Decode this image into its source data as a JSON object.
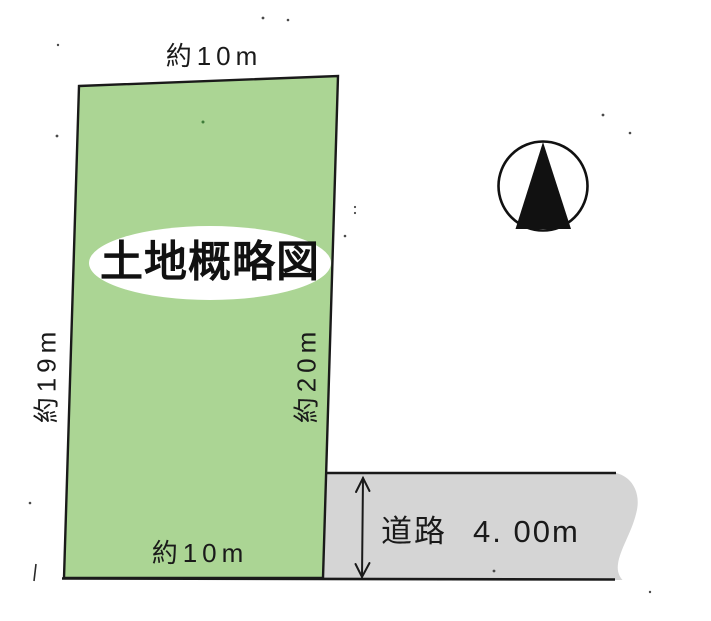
{
  "diagram": {
    "title": "土地概略図",
    "plot": {
      "fill": "#abd594",
      "outline": "#1a1a1a",
      "dimensions": {
        "top": "約10m",
        "left": "約19m",
        "right": "約20m",
        "bottom": "約10m"
      }
    },
    "road": {
      "fill": "#d5d5d5",
      "name": "道路",
      "width": "4. 00m"
    },
    "title_bubble_fill": "#ffffff",
    "ink": "#1a1a1a",
    "icons": {
      "compass": "north-compass-icon"
    }
  }
}
